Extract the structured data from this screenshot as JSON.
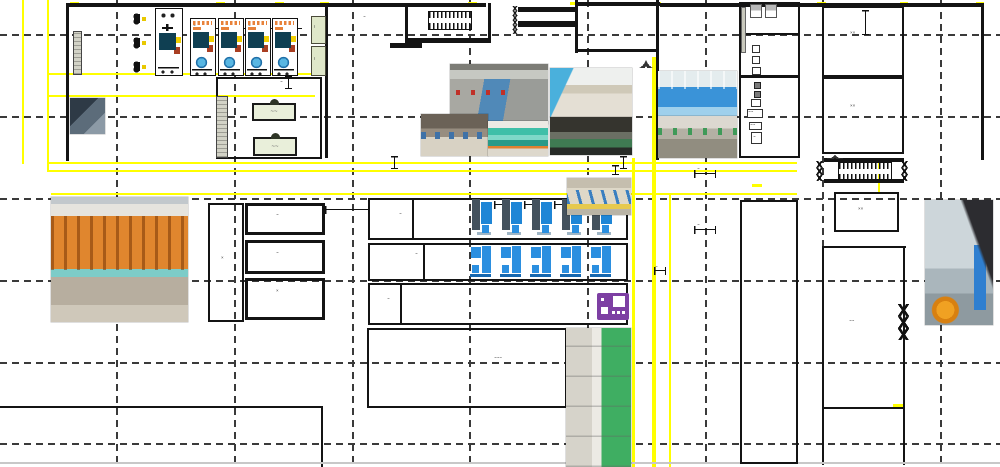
{
  "title": "factory-floor-plan",
  "palette": {
    "yellow": "#ffff00",
    "wall": "#141414",
    "grid": "#3a3a3a",
    "cyan": "#4cc0d8",
    "blue": "#2b8fe0",
    "slate": "#44525e",
    "purple": "#7d3fa3",
    "cabinet_green": "#dfe7c9",
    "table_green": "#e9efda"
  },
  "grid": {
    "v": [
      116,
      234,
      352,
      469,
      587,
      705,
      822,
      940
    ],
    "h": [
      34,
      116,
      198,
      280,
      362,
      443
    ]
  },
  "yellow_lines": [
    {
      "x": 22,
      "y": 0,
      "w": 2,
      "h": 164
    },
    {
      "x": 47,
      "y": 0,
      "w": 2,
      "h": 172
    },
    {
      "x": 47,
      "y": 73,
      "w": 279,
      "h": 2
    },
    {
      "x": 47,
      "y": 95,
      "w": 268,
      "h": 2
    },
    {
      "x": 47,
      "y": 162,
      "w": 750,
      "h": 2
    },
    {
      "x": 47,
      "y": 170,
      "w": 750,
      "h": 2
    },
    {
      "x": 51,
      "y": 193,
      "w": 746,
      "h": 2
    },
    {
      "x": 632,
      "y": 158,
      "w": 3,
      "h": 309
    },
    {
      "x": 652,
      "y": 57,
      "w": 4,
      "h": 410
    },
    {
      "x": 669,
      "y": 193,
      "w": 2,
      "h": 274
    },
    {
      "x": 878,
      "y": 163,
      "w": 2,
      "h": 30
    },
    {
      "x": 70,
      "y": 2,
      "w": 9,
      "h": 3
    },
    {
      "x": 216,
      "y": 2,
      "w": 9,
      "h": 3
    },
    {
      "x": 275,
      "y": 2,
      "w": 9,
      "h": 3
    },
    {
      "x": 320,
      "y": 2,
      "w": 9,
      "h": 3
    },
    {
      "x": 468,
      "y": 2,
      "w": 9,
      "h": 3
    },
    {
      "x": 570,
      "y": 2,
      "w": 8,
      "h": 3
    },
    {
      "x": 652,
      "y": 2,
      "w": 9,
      "h": 3
    },
    {
      "x": 740,
      "y": 2,
      "w": 9,
      "h": 3
    },
    {
      "x": 817,
      "y": 2,
      "w": 9,
      "h": 3
    },
    {
      "x": 900,
      "y": 2,
      "w": 8,
      "h": 3
    },
    {
      "x": 976,
      "y": 2,
      "w": 8,
      "h": 3
    },
    {
      "x": 752,
      "y": 184,
      "w": 10,
      "h": 3
    },
    {
      "x": 893,
      "y": 404,
      "w": 10,
      "h": 3
    }
  ],
  "walls": [
    {
      "x": 66,
      "y": 3,
      "w": 420,
      "h": 4
    },
    {
      "x": 575,
      "y": 2,
      "w": 85,
      "h": 4
    },
    {
      "x": 660,
      "y": 3,
      "w": 323,
      "h": 4
    },
    {
      "x": 66,
      "y": 3,
      "w": 3,
      "h": 158
    },
    {
      "x": 325,
      "y": 3,
      "w": 3,
      "h": 155
    },
    {
      "x": 405,
      "y": 3,
      "w": 3,
      "h": 40
    },
    {
      "x": 488,
      "y": 3,
      "w": 3,
      "h": 40
    },
    {
      "x": 405,
      "y": 38,
      "w": 86,
      "h": 5
    },
    {
      "x": 390,
      "y": 43,
      "w": 32,
      "h": 5
    },
    {
      "x": 518,
      "y": 7,
      "w": 58,
      "h": 5
    },
    {
      "x": 518,
      "y": 21,
      "w": 58,
      "h": 6
    },
    {
      "x": 575,
      "y": 0,
      "w": 3,
      "h": 53
    },
    {
      "x": 575,
      "y": 49,
      "w": 84,
      "h": 3
    },
    {
      "x": 656,
      "y": 0,
      "w": 3,
      "h": 160
    },
    {
      "x": 981,
      "y": 3,
      "w": 3,
      "h": 157
    },
    {
      "x": 0,
      "y": 406,
      "w": 323,
      "h": 2
    },
    {
      "x": 321,
      "y": 406,
      "w": 2,
      "h": 61
    },
    {
      "x": 824,
      "y": 158,
      "w": 80,
      "h": 4
    },
    {
      "x": 824,
      "y": 179,
      "w": 80,
      "h": 4
    },
    {
      "x": 822,
      "y": 246,
      "w": 84,
      "h": 2
    },
    {
      "x": 822,
      "y": 246,
      "w": 2,
      "h": 219
    },
    {
      "x": 903,
      "y": 246,
      "w": 2,
      "h": 219
    },
    {
      "x": 823,
      "y": 407,
      "w": 81,
      "h": 2
    },
    {
      "x": 412,
      "y": 198,
      "w": 2,
      "h": 42
    },
    {
      "x": 423,
      "y": 243,
      "w": 2,
      "h": 38
    },
    {
      "x": 400,
      "y": 283,
      "w": 2,
      "h": 42
    },
    {
      "x": 740,
      "y": 33,
      "w": 59,
      "h": 1.5
    },
    {
      "x": 740,
      "y": 75,
      "w": 59,
      "h": 2.5
    },
    {
      "x": 206,
      "y": 28,
      "w": 96,
      "h": 1
    },
    {
      "x": 0,
      "y": 462,
      "w": 1000,
      "h": 1.5,
      "light": true
    }
  ],
  "rooms": [
    {
      "x": 216,
      "y": 77,
      "w": 106,
      "h": 82,
      "bw": 2
    },
    {
      "x": 739,
      "y": 2,
      "w": 61,
      "h": 156,
      "bw": 2.5
    },
    {
      "x": 822,
      "y": 6,
      "w": 82,
      "h": 71,
      "bw": 2.5
    },
    {
      "x": 822,
      "y": 77,
      "w": 82,
      "h": 77,
      "bw": 2.5
    },
    {
      "x": 834,
      "y": 192,
      "w": 65,
      "h": 40,
      "bw": 2.5
    },
    {
      "x": 740,
      "y": 200,
      "w": 58,
      "h": 264,
      "bw": 2.5
    },
    {
      "x": 368,
      "y": 198,
      "w": 260,
      "h": 42,
      "bw": 2.5
    },
    {
      "x": 368,
      "y": 243,
      "w": 260,
      "h": 38,
      "bw": 2.5
    },
    {
      "x": 368,
      "y": 283,
      "w": 260,
      "h": 42,
      "bw": 2.5
    },
    {
      "x": 367,
      "y": 328,
      "w": 200,
      "h": 80,
      "bw": 2.5
    },
    {
      "x": 208,
      "y": 203,
      "w": 36,
      "h": 119,
      "bw": 2.5
    },
    {
      "x": 245,
      "y": 203,
      "w": 80,
      "h": 32,
      "bw": 3
    },
    {
      "x": 245,
      "y": 240,
      "w": 80,
      "h": 34,
      "bw": 3
    },
    {
      "x": 245,
      "y": 278,
      "w": 80,
      "h": 42,
      "bw": 3
    }
  ],
  "labels": [
    {
      "x": 363,
      "y": 15,
      "t": "~"
    },
    {
      "x": 850,
      "y": 31,
      "t": "××"
    },
    {
      "x": 850,
      "y": 104,
      "t": "××"
    },
    {
      "x": 858,
      "y": 207,
      "t": "××"
    },
    {
      "x": 849,
      "y": 319,
      "t": "~~"
    },
    {
      "x": 221,
      "y": 256,
      "t": "×"
    },
    {
      "x": 276,
      "y": 213,
      "t": "~"
    },
    {
      "x": 276,
      "y": 251,
      "t": "~"
    },
    {
      "x": 276,
      "y": 289,
      "t": "×"
    },
    {
      "x": 399,
      "y": 212,
      "t": "~"
    },
    {
      "x": 415,
      "y": 252,
      "t": "~"
    },
    {
      "x": 387,
      "y": 297,
      "t": "~"
    },
    {
      "x": 494,
      "y": 356,
      "t": "~~~"
    },
    {
      "x": 934,
      "y": 209,
      "t": "~"
    },
    {
      "x": 655,
      "y": 265,
      "t": "~"
    },
    {
      "x": 697,
      "y": 167,
      "t": "~"
    },
    {
      "x": 697,
      "y": 223,
      "t": "~"
    },
    {
      "x": 193,
      "y": 24,
      "t": "~"
    },
    {
      "x": 248,
      "y": 24,
      "t": "~"
    },
    {
      "x": 280,
      "y": 80,
      "t": "~"
    },
    {
      "x": 748,
      "y": 110,
      "t": "~~"
    },
    {
      "x": 750,
      "y": 123,
      "t": "~~"
    },
    {
      "x": 753,
      "y": 135,
      "t": "~"
    },
    {
      "x": 314,
      "y": 25,
      "t": "᎒"
    },
    {
      "x": 314,
      "y": 57,
      "t": "᎒"
    }
  ],
  "tables": [
    {
      "x": 252,
      "y": 103,
      "w": 44,
      "h": 18,
      "t": "~~"
    },
    {
      "x": 253,
      "y": 137,
      "w": 44,
      "h": 19,
      "t": "~~"
    }
  ],
  "graybars": [
    {
      "x": 73,
      "y": 31,
      "w": 9,
      "h": 44
    },
    {
      "x": 216,
      "y": 96,
      "w": 12,
      "h": 62
    }
  ],
  "green_cabinets": [
    {
      "x": 311,
      "y": 16,
      "w": 15,
      "h": 28
    },
    {
      "x": 311,
      "y": 46,
      "w": 15,
      "h": 30
    }
  ],
  "clamps": [
    {
      "x": 131,
      "y": 12
    },
    {
      "x": 131,
      "y": 36
    },
    {
      "x": 131,
      "y": 60
    }
  ],
  "stairs": [
    {
      "x": 428,
      "y": 11,
      "w": 44,
      "h": 19
    },
    {
      "x": 838,
      "y": 162,
      "w": 54,
      "h": 18
    }
  ],
  "lockers": [
    {
      "x": 750,
      "y": 4,
      "w": 12,
      "h": 14
    },
    {
      "x": 765,
      "y": 4,
      "w": 12,
      "h": 14
    }
  ],
  "utility_boxes": [
    {
      "x": 741,
      "y": 7,
      "w": 5,
      "h": 46,
      "k": "g"
    },
    {
      "x": 752,
      "y": 45,
      "w": 8,
      "h": 8,
      "k": "w"
    },
    {
      "x": 752,
      "y": 56,
      "w": 8,
      "h": 8,
      "k": "w"
    },
    {
      "x": 752,
      "y": 67,
      "w": 9,
      "h": 8,
      "k": "w"
    },
    {
      "x": 754,
      "y": 82,
      "w": 7,
      "h": 7,
      "k": "d"
    },
    {
      "x": 754,
      "y": 91,
      "w": 7,
      "h": 7,
      "k": "d"
    },
    {
      "x": 751,
      "y": 99,
      "w": 10,
      "h": 8,
      "k": "w"
    },
    {
      "x": 747,
      "y": 109,
      "w": 16,
      "h": 9,
      "k": "w"
    },
    {
      "x": 749,
      "y": 122,
      "w": 13,
      "h": 8,
      "k": "w"
    },
    {
      "x": 751,
      "y": 132,
      "w": 11,
      "h": 12,
      "k": "w"
    }
  ],
  "zigzags": [
    {
      "x": 511,
      "y": 6,
      "w": 8,
      "h": 14
    },
    {
      "x": 511,
      "y": 20,
      "w": 8,
      "h": 14
    },
    {
      "x": 815,
      "y": 161,
      "w": 9,
      "h": 20
    },
    {
      "x": 900,
      "y": 161,
      "w": 9,
      "h": 20
    },
    {
      "x": 898,
      "y": 304,
      "w": 11,
      "h": 36
    }
  ],
  "door_arcs": [
    {
      "x": 633,
      "y": 56,
      "w": 13,
      "h": 12,
      "s": "l"
    },
    {
      "x": 646,
      "y": 56,
      "w": 13,
      "h": 12,
      "s": "r"
    },
    {
      "x": 827,
      "y": 149,
      "w": 8,
      "h": 10,
      "s": "l"
    },
    {
      "x": 835,
      "y": 149,
      "w": 8,
      "h": 10,
      "s": "r"
    }
  ],
  "dims_v": [
    {
      "x": 391,
      "y": 156,
      "h": 13
    },
    {
      "x": 620,
      "y": 156,
      "h": 13
    },
    {
      "x": 612,
      "y": 165,
      "h": 10
    },
    {
      "x": 285,
      "y": 76,
      "h": 13
    },
    {
      "x": 862,
      "y": 10,
      "h": 25
    }
  ],
  "dims_h": [
    {
      "x": 694,
      "y": 170,
      "w": 22
    },
    {
      "x": 694,
      "y": 226,
      "w": 22
    },
    {
      "x": 325,
      "y": 206,
      "w": 44
    },
    {
      "x": 933,
      "y": 212,
      "w": 14
    },
    {
      "x": 654,
      "y": 267,
      "w": 12
    },
    {
      "x": 494,
      "y": 201,
      "w": 10
    },
    {
      "x": 524,
      "y": 201,
      "w": 10
    },
    {
      "x": 554,
      "y": 201,
      "w": 10
    },
    {
      "x": 584,
      "y": 201,
      "w": 10
    }
  ],
  "machines": {
    "cnc": [
      {
        "x": 155,
        "y": 8,
        "w": 28,
        "h": 68,
        "v": "v1"
      },
      {
        "x": 190,
        "y": 18,
        "w": 26,
        "h": 58,
        "v": "v2"
      },
      {
        "x": 218,
        "y": 18,
        "w": 26,
        "h": 58,
        "v": "v2"
      },
      {
        "x": 245,
        "y": 18,
        "w": 26,
        "h": 58,
        "v": "v2"
      },
      {
        "x": 272,
        "y": 18,
        "w": 26,
        "h": 58,
        "v": "v2"
      }
    ],
    "blue_row1": {
      "y": 197,
      "w": 23,
      "h": 39,
      "xs": [
        472,
        502,
        532,
        562,
        592
      ]
    },
    "blue_row2": {
      "y": 244,
      "w": 24,
      "h": 34,
      "xs": [
        470,
        500,
        530,
        560,
        590
      ]
    },
    "purple": {
      "x": 597,
      "y": 293,
      "w": 32,
      "h": 27
    }
  },
  "photos": [
    {
      "kind": "racks",
      "x": 51,
      "y": 197,
      "w": 137,
      "h": 125
    },
    {
      "kind": "dark",
      "x": 70,
      "y": 98,
      "w": 35,
      "h": 36
    },
    {
      "kind": "aisle",
      "x": 450,
      "y": 64,
      "w": 98,
      "h": 60
    },
    {
      "kind": "workshop",
      "x": 421,
      "y": 114,
      "w": 67,
      "h": 42
    },
    {
      "kind": "booth",
      "x": 488,
      "y": 121,
      "w": 60,
      "h": 35
    },
    {
      "kind": "lobby",
      "x": 550,
      "y": 68,
      "w": 82,
      "h": 49
    },
    {
      "kind": "showroom",
      "x": 550,
      "y": 117,
      "w": 82,
      "h": 38
    },
    {
      "kind": "pool",
      "x": 658,
      "y": 71,
      "w": 79,
      "h": 45
    },
    {
      "kind": "exhibit",
      "x": 658,
      "y": 116,
      "w": 79,
      "h": 42
    },
    {
      "kind": "line2",
      "x": 567,
      "y": 178,
      "w": 64,
      "h": 37
    },
    {
      "kind": "corridor",
      "x": 925,
      "y": 200,
      "w": 68,
      "h": 125
    },
    {
      "kind": "greenline",
      "x": 566,
      "y": 328,
      "w": 65,
      "h": 139
    }
  ]
}
